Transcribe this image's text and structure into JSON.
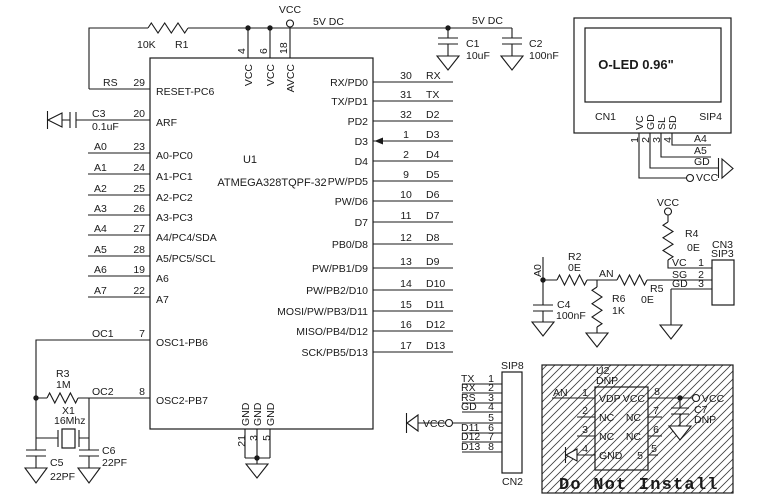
{
  "power": {
    "vcc": "VCC",
    "rail1": "5V DC",
    "rail2": "5V DC"
  },
  "u1": {
    "ref": "U1",
    "part": "ATMEGA328TQPF-32",
    "top_pins": [
      {
        "num": "4",
        "name": "VCC"
      },
      {
        "num": "6",
        "name": "VCC"
      },
      {
        "num": "18",
        "name": "AVCC"
      }
    ],
    "bottom_pins": [
      {
        "num": "21",
        "name": "GND"
      },
      {
        "num": "3",
        "name": "GND"
      },
      {
        "num": "5",
        "name": "GND"
      }
    ],
    "left_pins": [
      {
        "net": "RS",
        "num": "29",
        "name": "RESET-PC6"
      },
      {
        "net": "",
        "num": "20",
        "name": "ARF"
      },
      {
        "net": "A0",
        "num": "23",
        "name": "A0-PC0"
      },
      {
        "net": "A1",
        "num": "24",
        "name": "A1-PC1"
      },
      {
        "net": "A2",
        "num": "25",
        "name": "A2-PC2"
      },
      {
        "net": "A3",
        "num": "26",
        "name": "A3-PC3"
      },
      {
        "net": "A4",
        "num": "27",
        "name": "A4/PC4/SDA"
      },
      {
        "net": "A5",
        "num": "28",
        "name": "A5/PC5/SCL"
      },
      {
        "net": "A6",
        "num": "19",
        "name": "A6"
      },
      {
        "net": "A7",
        "num": "22",
        "name": "A7"
      },
      {
        "net": "OC1",
        "num": "7",
        "name": "OSC1-PB6"
      },
      {
        "net": "OC2",
        "num": "8",
        "name": "OSC2-PB7"
      }
    ],
    "right_pins": [
      {
        "name": "RX/PD0",
        "num": "30",
        "net": "RX"
      },
      {
        "name": "TX/PD1",
        "num": "31",
        "net": "TX"
      },
      {
        "name": "PD2",
        "num": "32",
        "net": "D2"
      },
      {
        "name": "D3",
        "num": "1",
        "net": "D3"
      },
      {
        "name": "D4",
        "num": "2",
        "net": "D4"
      },
      {
        "name": "PW/PD5",
        "num": "9",
        "net": "D5"
      },
      {
        "name": "PW/D6",
        "num": "10",
        "net": "D6"
      },
      {
        "name": "D7",
        "num": "11",
        "net": "D7"
      },
      {
        "name": "PB0/D8",
        "num": "12",
        "net": "D8"
      },
      {
        "name": "PW/PB1/D9",
        "num": "13",
        "net": "D9"
      },
      {
        "name": "PW/PB2/D10",
        "num": "14",
        "net": "D10"
      },
      {
        "name": "MOSI/PW/PB3/D11",
        "num": "15",
        "net": "D11"
      },
      {
        "name": "MISO/PB4/D12",
        "num": "16",
        "net": "D12"
      },
      {
        "name": "SCK/PB5/D13",
        "num": "17",
        "net": "D13"
      }
    ]
  },
  "components": {
    "r1": {
      "ref": "R1",
      "value": "10K"
    },
    "r2": {
      "ref": "R2",
      "value": "0E"
    },
    "r3": {
      "ref": "R3",
      "value": "1M"
    },
    "r4": {
      "ref": "R4",
      "value": "0E"
    },
    "r5": {
      "ref": "R5",
      "value": "0E"
    },
    "r6": {
      "ref": "R6",
      "value": "1K"
    },
    "c1": {
      "ref": "C1",
      "value": "10uF"
    },
    "c2": {
      "ref": "C2",
      "value": "100nF"
    },
    "c3": {
      "ref": "C3",
      "value": "0.1uF"
    },
    "c4": {
      "ref": "C4",
      "value": "100nF"
    },
    "c5": {
      "ref": "C5",
      "value": "22PF"
    },
    "c6": {
      "ref": "C6",
      "value": "22PF"
    },
    "c7": {
      "ref": "C7",
      "value": "DNP"
    },
    "x1": {
      "ref": "X1",
      "value": "16Mhz"
    }
  },
  "oled": {
    "title": "O-LED 0.96\"",
    "ref": "CN1",
    "type": "SIP4",
    "pin_names": [
      "VC",
      "GD",
      "SL",
      "SD"
    ],
    "pin_nums": [
      "1",
      "2",
      "3",
      "4"
    ],
    "nets": [
      "A4",
      "A5",
      "GD",
      "VCC"
    ]
  },
  "analog": {
    "a0": "A0",
    "an": "AN",
    "cn3": {
      "ref": "CN3",
      "type": "SIP3",
      "pins": [
        {
          "name": "VC",
          "num": "1"
        },
        {
          "name": "SG",
          "num": "2"
        },
        {
          "name": "GD",
          "num": "3"
        }
      ]
    }
  },
  "cn2": {
    "ref": "CN2",
    "type": "SIP8",
    "pins": [
      {
        "net": "TX",
        "num": "1"
      },
      {
        "net": "RX",
        "num": "2"
      },
      {
        "net": "RS",
        "num": "3"
      },
      {
        "net": "GD",
        "num": "4"
      },
      {
        "net": "VCC",
        "num": "5"
      },
      {
        "net": "D11",
        "num": "6"
      },
      {
        "net": "D12",
        "num": "7"
      },
      {
        "net": "D13",
        "num": "8"
      }
    ]
  },
  "dni": {
    "note": "Do Not Install",
    "an": "AN",
    "vcc": "VCC",
    "u2": {
      "ref": "U2",
      "dnp": "DNP",
      "left_pins": [
        {
          "num": "1",
          "name": "VDP"
        },
        {
          "num": "2",
          "name": "NC"
        },
        {
          "num": "3",
          "name": "NC"
        },
        {
          "num": "4",
          "name": "GND"
        }
      ],
      "right_pins": [
        {
          "num": "8",
          "name": "VCC"
        },
        {
          "num": "7",
          "name": "NC"
        },
        {
          "num": "6",
          "name": "NC"
        },
        {
          "num": "5",
          "name": "5"
        }
      ]
    }
  }
}
